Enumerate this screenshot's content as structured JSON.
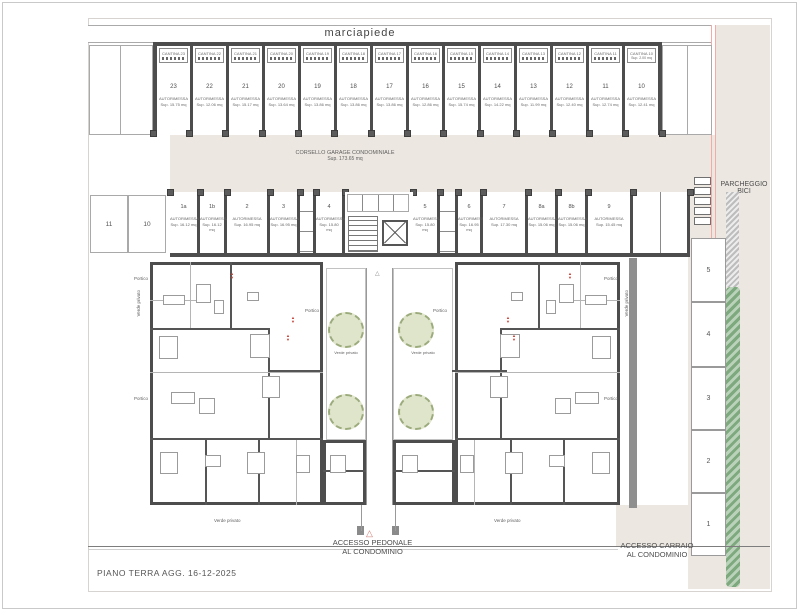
{
  "labels": {
    "marciapiede": "marciapiede",
    "corsello_line1": "CORSELLO GARAGE CONDOMINIALE",
    "corsello_line2": "Sup. 173.65 mq",
    "parcheggio_bici_line1": "PARCHEGGIO",
    "parcheggio_bici_line2": "BICI",
    "accesso_pedonale_line1": "ACCESSO PEDONALE",
    "accesso_pedonale_line2": "AL CONDOMINIO",
    "accesso_carraio_line1": "ACCESSO CARRAIO",
    "accesso_carraio_line2": "AL CONDOMINIO",
    "verde_privato": "Verde privato",
    "portico": "Portico",
    "autorimessa": "AUTORIMESSA",
    "title_note": "PIANO TERRA AGG. 16-12-2025"
  },
  "garages_top": [
    {
      "cantina": "CANTINA 23",
      "num": "23",
      "sup": "Sup. 15.75 mq"
    },
    {
      "cantina": "CANTINA 22",
      "num": "22",
      "sup": "Sup. 12.06 mq"
    },
    {
      "cantina": "CANTINA 21",
      "num": "21",
      "sup": "Sup. 15.17 mq"
    },
    {
      "cantina": "CANTINA 20",
      "num": "20",
      "sup": "Sup. 13.64 mq"
    },
    {
      "cantina": "CANTINA 19",
      "num": "19",
      "sup": "Sup. 13.86 mq"
    },
    {
      "cantina": "CANTINA 18",
      "num": "18",
      "sup": "Sup. 13.86 mq"
    },
    {
      "cantina": "CANTINA 17",
      "num": "17",
      "sup": "Sup. 13.86 mq"
    },
    {
      "cantina": "CANTINA 16",
      "num": "16",
      "sup": "Sup. 12.86 mq"
    },
    {
      "cantina": "CANTINA 15",
      "num": "15",
      "sup": "Sup. 15.74 mq"
    },
    {
      "cantina": "CANTINA 14",
      "num": "14",
      "sup": "Sup. 14.22 mq"
    },
    {
      "cantina": "CANTINA 13",
      "num": "13",
      "sup": "Sup. 11.99 mq"
    },
    {
      "cantina": "CANTINA 12",
      "num": "12",
      "sup": "Sup. 12.40 mq"
    },
    {
      "cantina": "CANTINA 11",
      "num": "11",
      "sup": "Sup. 12.74 mq"
    },
    {
      "cantina": "CANTINA 10",
      "cantina_sup": "Sup. 2.00 mq",
      "num": "10",
      "sup": "Sup. 12.41 mq"
    }
  ],
  "garages_bottom": [
    {
      "num": "1a",
      "sup": "Sup. 16.12 mq"
    },
    {
      "num": "1b",
      "sup": "Sup. 16.12 mq"
    },
    {
      "num": "2",
      "sup": "Sup. 16.95 mq"
    },
    {
      "num": "3",
      "sup": "Sup. 16.95 mq"
    },
    {
      "num": "4",
      "sup": "Sup. 15.80 mq"
    },
    {
      "num": "5",
      "sup": "Sup. 15.80 mq"
    },
    {
      "num": "6",
      "sup": "Sup. 16.95 mq"
    },
    {
      "num": "7",
      "sup": "Sup. 17.30 mq"
    },
    {
      "num": "8a",
      "sup": "Sup. 15.06 mq"
    },
    {
      "num": "8b",
      "sup": "Sup. 15.06 mq"
    },
    {
      "num": "9",
      "sup": "Sup. 15.45 mq"
    }
  ],
  "parking_left": [
    "11",
    "10"
  ],
  "parking_right": [
    "5",
    "4",
    "3",
    "2",
    "1"
  ]
}
